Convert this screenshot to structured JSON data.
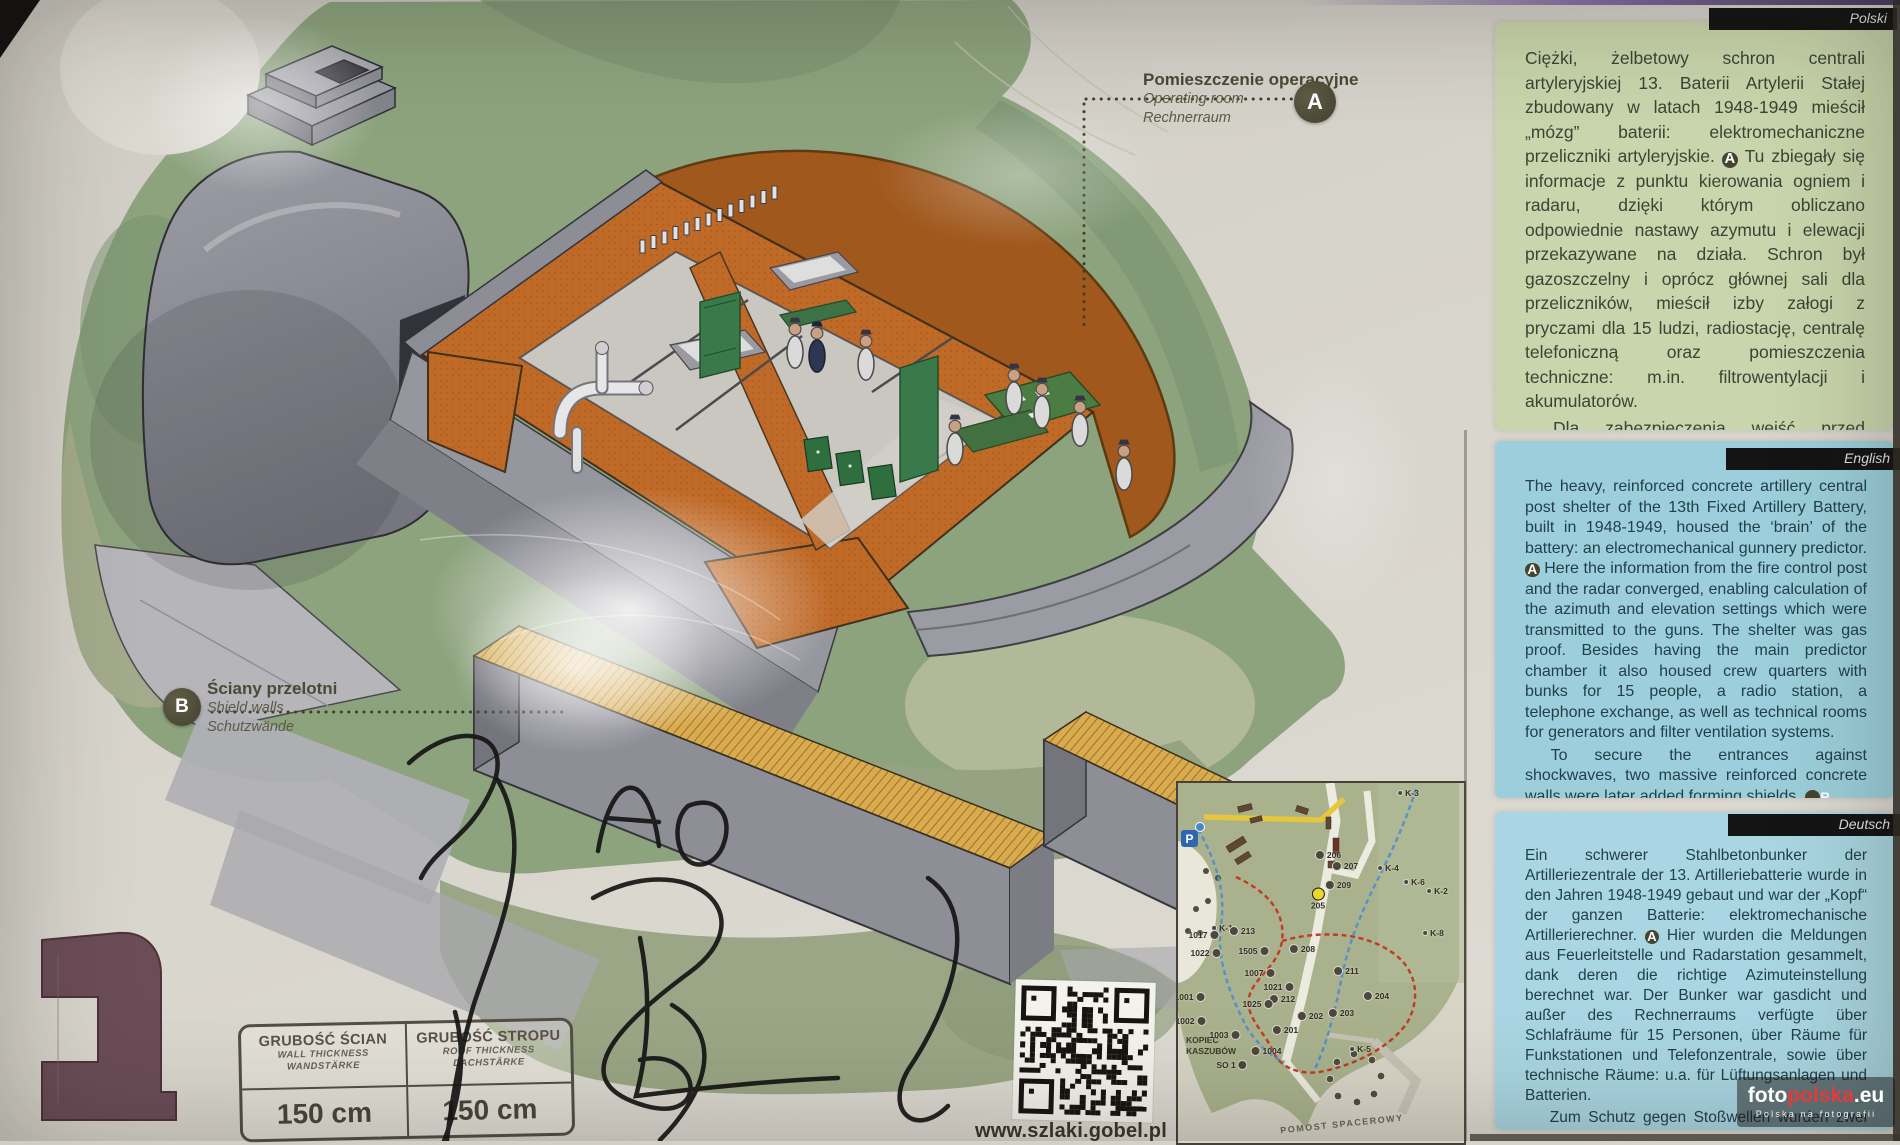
{
  "board": {
    "panels": [
      {
        "lang": "Polski",
        "bg": "#c9d5ac",
        "paragraphs": [
          [
            {
              "t": "Ciężki, żelbetowy schron centrali artyleryjskiej 13. Baterii Artylerii Stałej zbudowany w latach 1948-1949 mieścił „mózg” baterii: elektromechaniczne przeliczniki artyleryjskie. "
            },
            {
              "m": "A"
            },
            {
              "t": " Tu zbiegały się informacje z punktu kierowania ogniem i radaru, dzięki którym obliczano odpowiednie nastawy azymutu i elewacji przekazywane na działa. Schron był gazoszczelny i oprócz głównej sali dla przeliczników, mieścił izby załogi z pryczami dla 15 ludzi, radiostację, centralę telefoniczną oraz pomieszczenia techniczne: m.in. filtrowentylacji i akumulatorów."
            }
          ],
          [
            {
              "t": "Dla zabezpieczenia wejść przed działaniem fali uderzeniowej, dobudowano dwie masywne ściany żelbetowe tworzące przelotnie. "
            },
            {
              "m": "B"
            }
          ]
        ]
      },
      {
        "lang": "English",
        "bg": "#9ccfdb",
        "paragraphs": [
          [
            {
              "t": "The heavy, reinforced concrete artillery central post shelter of the 13th Fixed Artillery Battery, built in 1948-1949, housed the ‘brain’ of the battery: an electromechanical gunnery predictor. "
            },
            {
              "m": "A"
            },
            {
              "t": " Here the information from the fire control post and the radar converged, enabling calculation of the azimuth and elevation settings which were transmitted to the guns. The shelter was gas proof. Besides having the main predictor chamber it also housed crew quarters with bunks for 15 people, a radio station, a telephone exchange, as well as technical rooms for generators and filter ventilation systems."
            }
          ],
          [
            {
              "t": "To secure the entrances against shockwaves, two massive reinforced concrete walls were later added forming shields. "
            },
            {
              "m": "B"
            }
          ]
        ]
      },
      {
        "lang": "Deutsch",
        "bg": "#a9d6e2",
        "paragraphs": [
          [
            {
              "t": "Ein schwerer Stahlbetonbunker der Artilleriezentrale der 13. Artilleriebatterie wurde in den Jahren 1948-1949 gebaut und war der „Kopf“ der ganzen Batterie: elektromechanische Artillerierechner. "
            },
            {
              "m": "A"
            },
            {
              "t": " Hier wurden die Meldungen aus Feuerleitstelle und Radarstation gesammelt, dank deren die richtige Azimuteinstellung berechnet war. Der Bunker war gasdicht und außer des Rechnerraums verfügte über Schlafräume für 15 Personen, über Räume für Funkstationen und Telefonzentrale, sowie über technische Räume: u.a. für Lüftungsanlagen und Batterien."
            }
          ],
          [
            {
              "t": "Zum Schutz gegen Stoßwellen wurden zwei massive Eisenbetonwände gebaut. "
            },
            {
              "m": "B"
            }
          ]
        ]
      }
    ],
    "callouts": {
      "operating_room": {
        "marker": "A",
        "pl": "Pomieszczenie operacyjne",
        "en": "Operating room",
        "de": "Rechnerraum"
      },
      "shield_walls": {
        "marker": "B",
        "pl": "Ściany przelotni",
        "en": "Shield walls",
        "de": "Schutzwände"
      }
    },
    "thickness_table": {
      "columns": [
        {
          "pl": "GRUBOŚĆ ŚCIAN",
          "en": "WALL THICKNESS",
          "de": "WANDSTÄRKE",
          "value": "150 cm"
        },
        {
          "pl": "GRUBOŚĆ STROPU",
          "en": "ROOF THICKNESS",
          "de": "DACHSTÄRKE",
          "value": "150 cm"
        }
      ]
    },
    "qr": {
      "caption": "www.szlaki.gobel.pl"
    },
    "map": {
      "labels": {
        "mound": "KOPIEC KASZUBÓW",
        "pier": "POMOST SPACEROWY",
        "parking": "P"
      },
      "points": [
        {
          "label": "K-3",
          "x": 230,
          "y": 10,
          "kind": "k"
        },
        {
          "label": "206",
          "x": 150,
          "y": 72,
          "kind": "station"
        },
        {
          "label": "207",
          "x": 167,
          "y": 83,
          "kind": "station"
        },
        {
          "label": "K-4",
          "x": 210,
          "y": 85,
          "kind": "k"
        },
        {
          "label": "K-6",
          "x": 236,
          "y": 99,
          "kind": "k"
        },
        {
          "label": "K-2",
          "x": 259,
          "y": 108,
          "kind": "k"
        },
        {
          "label": "209",
          "x": 160,
          "y": 102,
          "kind": "station"
        },
        {
          "label": "205",
          "x": 140,
          "y": 116,
          "kind": "yellow"
        },
        {
          "label": "K-1",
          "x": 44,
          "y": 145,
          "kind": "k"
        },
        {
          "label": "213",
          "x": 64,
          "y": 148,
          "kind": "station"
        },
        {
          "label": "1017",
          "x": 26,
          "y": 152,
          "kind": "station_l"
        },
        {
          "label": "K-8",
          "x": 255,
          "y": 150,
          "kind": "k"
        },
        {
          "label": "208",
          "x": 124,
          "y": 166,
          "kind": "station"
        },
        {
          "label": "1505",
          "x": 76,
          "y": 168,
          "kind": "station_l"
        },
        {
          "label": "1022",
          "x": 28,
          "y": 170,
          "kind": "station_l"
        },
        {
          "label": "211",
          "x": 168,
          "y": 188,
          "kind": "station"
        },
        {
          "label": "1007",
          "x": 82,
          "y": 190,
          "kind": "station_l"
        },
        {
          "label": "1021",
          "x": 101,
          "y": 204,
          "kind": "station_l"
        },
        {
          "label": "204",
          "x": 198,
          "y": 213,
          "kind": "station"
        },
        {
          "label": "1001",
          "x": 12,
          "y": 214,
          "kind": "station_l"
        },
        {
          "label": "212",
          "x": 104,
          "y": 216,
          "kind": "station"
        },
        {
          "label": "1025",
          "x": 80,
          "y": 221,
          "kind": "station_l"
        },
        {
          "label": "203",
          "x": 163,
          "y": 230,
          "kind": "station"
        },
        {
          "label": "202",
          "x": 132,
          "y": 233,
          "kind": "station"
        },
        {
          "label": "1002",
          "x": 13,
          "y": 238,
          "kind": "station_l"
        },
        {
          "label": "201",
          "x": 107,
          "y": 247,
          "kind": "station"
        },
        {
          "label": "1003",
          "x": 47,
          "y": 252,
          "kind": "station_l"
        },
        {
          "label": "K-5",
          "x": 182,
          "y": 266,
          "kind": "k"
        },
        {
          "label": "1004",
          "x": 88,
          "y": 268,
          "kind": "station"
        },
        {
          "label": "SO 1",
          "x": 54,
          "y": 282,
          "kind": "station_l"
        }
      ]
    },
    "watermark": {
      "foto": "foto",
      "polska": "polska",
      "eu": ".eu",
      "subtitle": "Polska na fotografii",
      "accent": "#e23b3b"
    }
  }
}
